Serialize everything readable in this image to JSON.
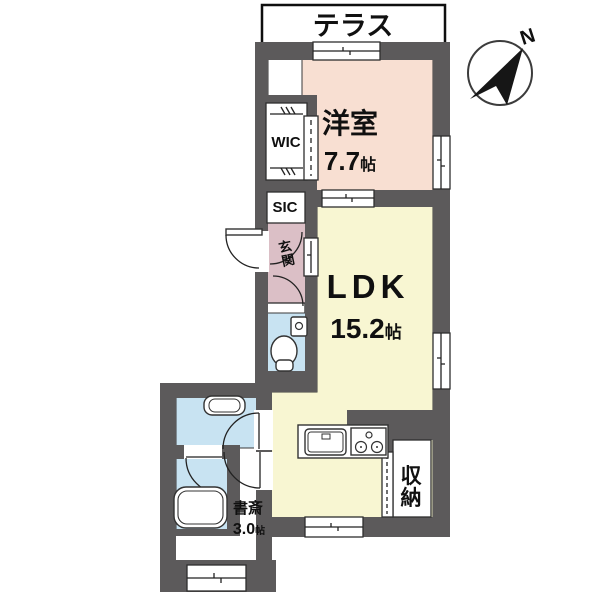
{
  "floorplan": {
    "terrace_label": "テラス",
    "compass_n": "N",
    "western_room": {
      "name": "洋室",
      "size": "7.7",
      "unit": "帖"
    },
    "ldk": {
      "name": "LDK",
      "size": "15.2",
      "unit": "帖"
    },
    "wic_label": "WIC",
    "sic_label": "SIC",
    "entrance": {
      "char1": "玄",
      "char2": "関"
    },
    "storage": {
      "char1": "収",
      "char2": "納"
    },
    "study": {
      "name": "書斎",
      "size": "3.0",
      "unit": "帖"
    },
    "colors": {
      "wall": "#5c5a5b",
      "western_room_floor": "#f8dfd2",
      "ldk_floor": "#f8f6d2",
      "entrance_floor": "#dbbfc6",
      "wet_area_floor": "#c8e3f2",
      "line": "#2a2a2a"
    }
  }
}
